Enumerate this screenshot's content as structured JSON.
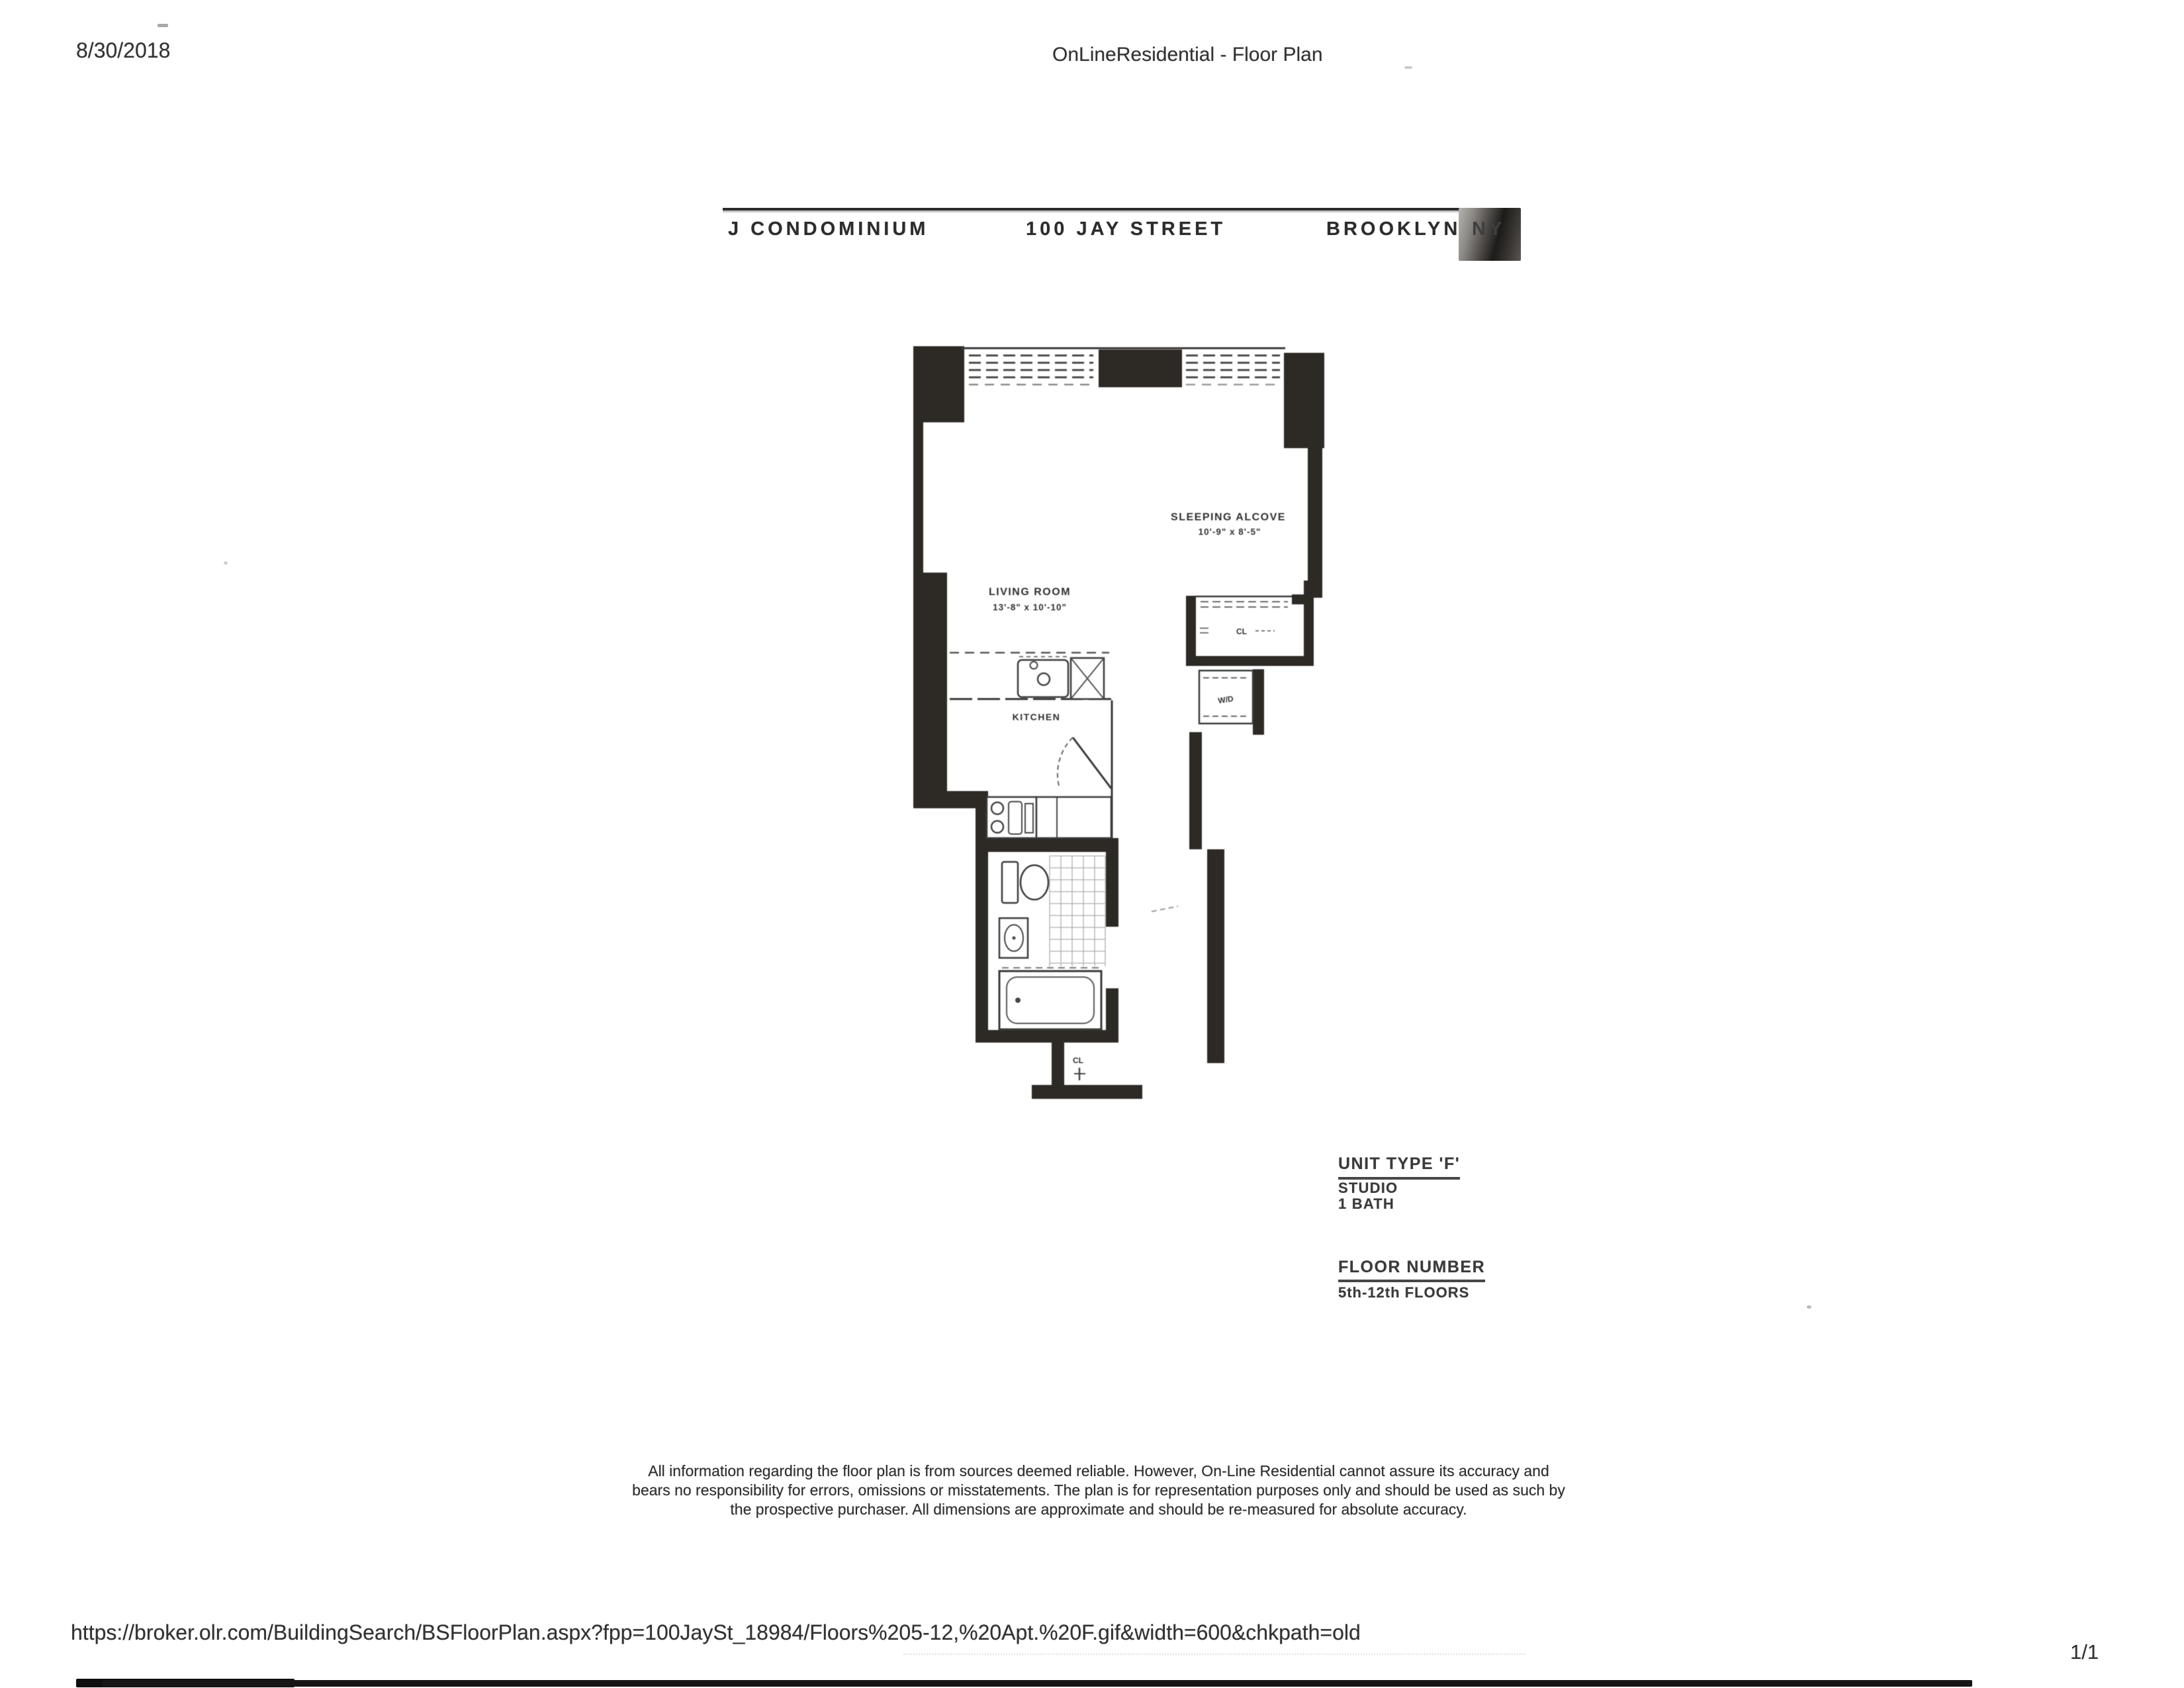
{
  "page": {
    "date": "8/30/2018",
    "title": "OnLineResidential - Floor Plan",
    "page_number": "1/1",
    "footer_url": "https://broker.olr.com/BuildingSearch/BSFloorPlan.aspx?fpp=100JaySt_18984/Floors%205-12,%20Apt.%20F.gif&width=600&chkpath=old"
  },
  "building_header": {
    "name": "J CONDOMINIUM",
    "address": "100 JAY STREET",
    "city": "BROOKLYN,",
    "state": "NY"
  },
  "floor_plan": {
    "sleeping_alcove": {
      "label": "SLEEPING ALCOVE",
      "dims": "10'-9\" x 8'-5\""
    },
    "living_room": {
      "label": "LIVING ROOM",
      "dims": "13'-8\" x 10'-10\""
    },
    "kitchen": {
      "label": "KITCHEN"
    },
    "closet": {
      "label": "CL"
    },
    "washer_dryer": {
      "label": "W/D"
    },
    "entry_closet": {
      "label": "CL"
    }
  },
  "unit_info": {
    "unit_type": "UNIT TYPE 'F'",
    "layout": "STUDIO",
    "bath": "1 BATH",
    "floor_label": "FLOOR NUMBER",
    "floors": "5th-12th FLOORS"
  },
  "disclaimer": {
    "lines": [
      "All information regarding the floor plan is from sources deemed reliable.  However, On-Line Residential cannot assure its accuracy and",
      "bears no responsibility for errors, omissions or misstatements. The plan is for representation purposes only and should be used as such by",
      "the prospective purchaser. All dimensions are approximate and should be re-measured for absolute accuracy."
    ]
  },
  "colors": {
    "ink": "#2e2e2e",
    "wall": "#2d2a26",
    "paper": "#ffffff",
    "scan_bar": "#161616"
  }
}
